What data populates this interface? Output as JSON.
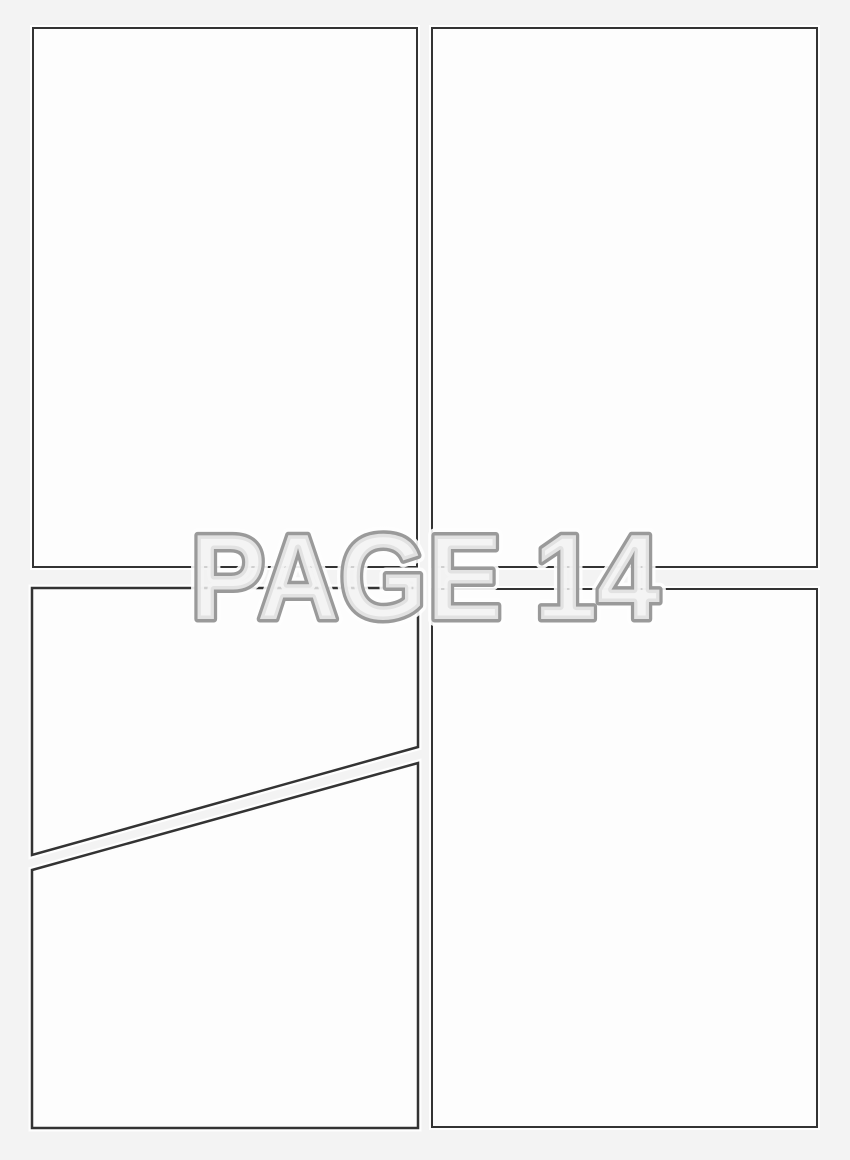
{
  "page": {
    "label": "PAGE 14"
  },
  "panels": [
    {
      "name": "panel-1",
      "position": "top-left"
    },
    {
      "name": "panel-2",
      "position": "top-right"
    },
    {
      "name": "panel-3a",
      "position": "bottom-left-upper",
      "note": "diagonal split upper"
    },
    {
      "name": "panel-3b",
      "position": "bottom-left-lower",
      "note": "diagonal split lower"
    },
    {
      "name": "panel-4",
      "position": "bottom-right"
    }
  ],
  "colors": {
    "background": "#f3f3f3",
    "panel_fill": "#fdfdfd",
    "panel_border": "#333333",
    "label_outline": "#9a9a9a",
    "label_fill": "rgba(241,241,241,0.82)",
    "label_halo": "#ffffff"
  }
}
